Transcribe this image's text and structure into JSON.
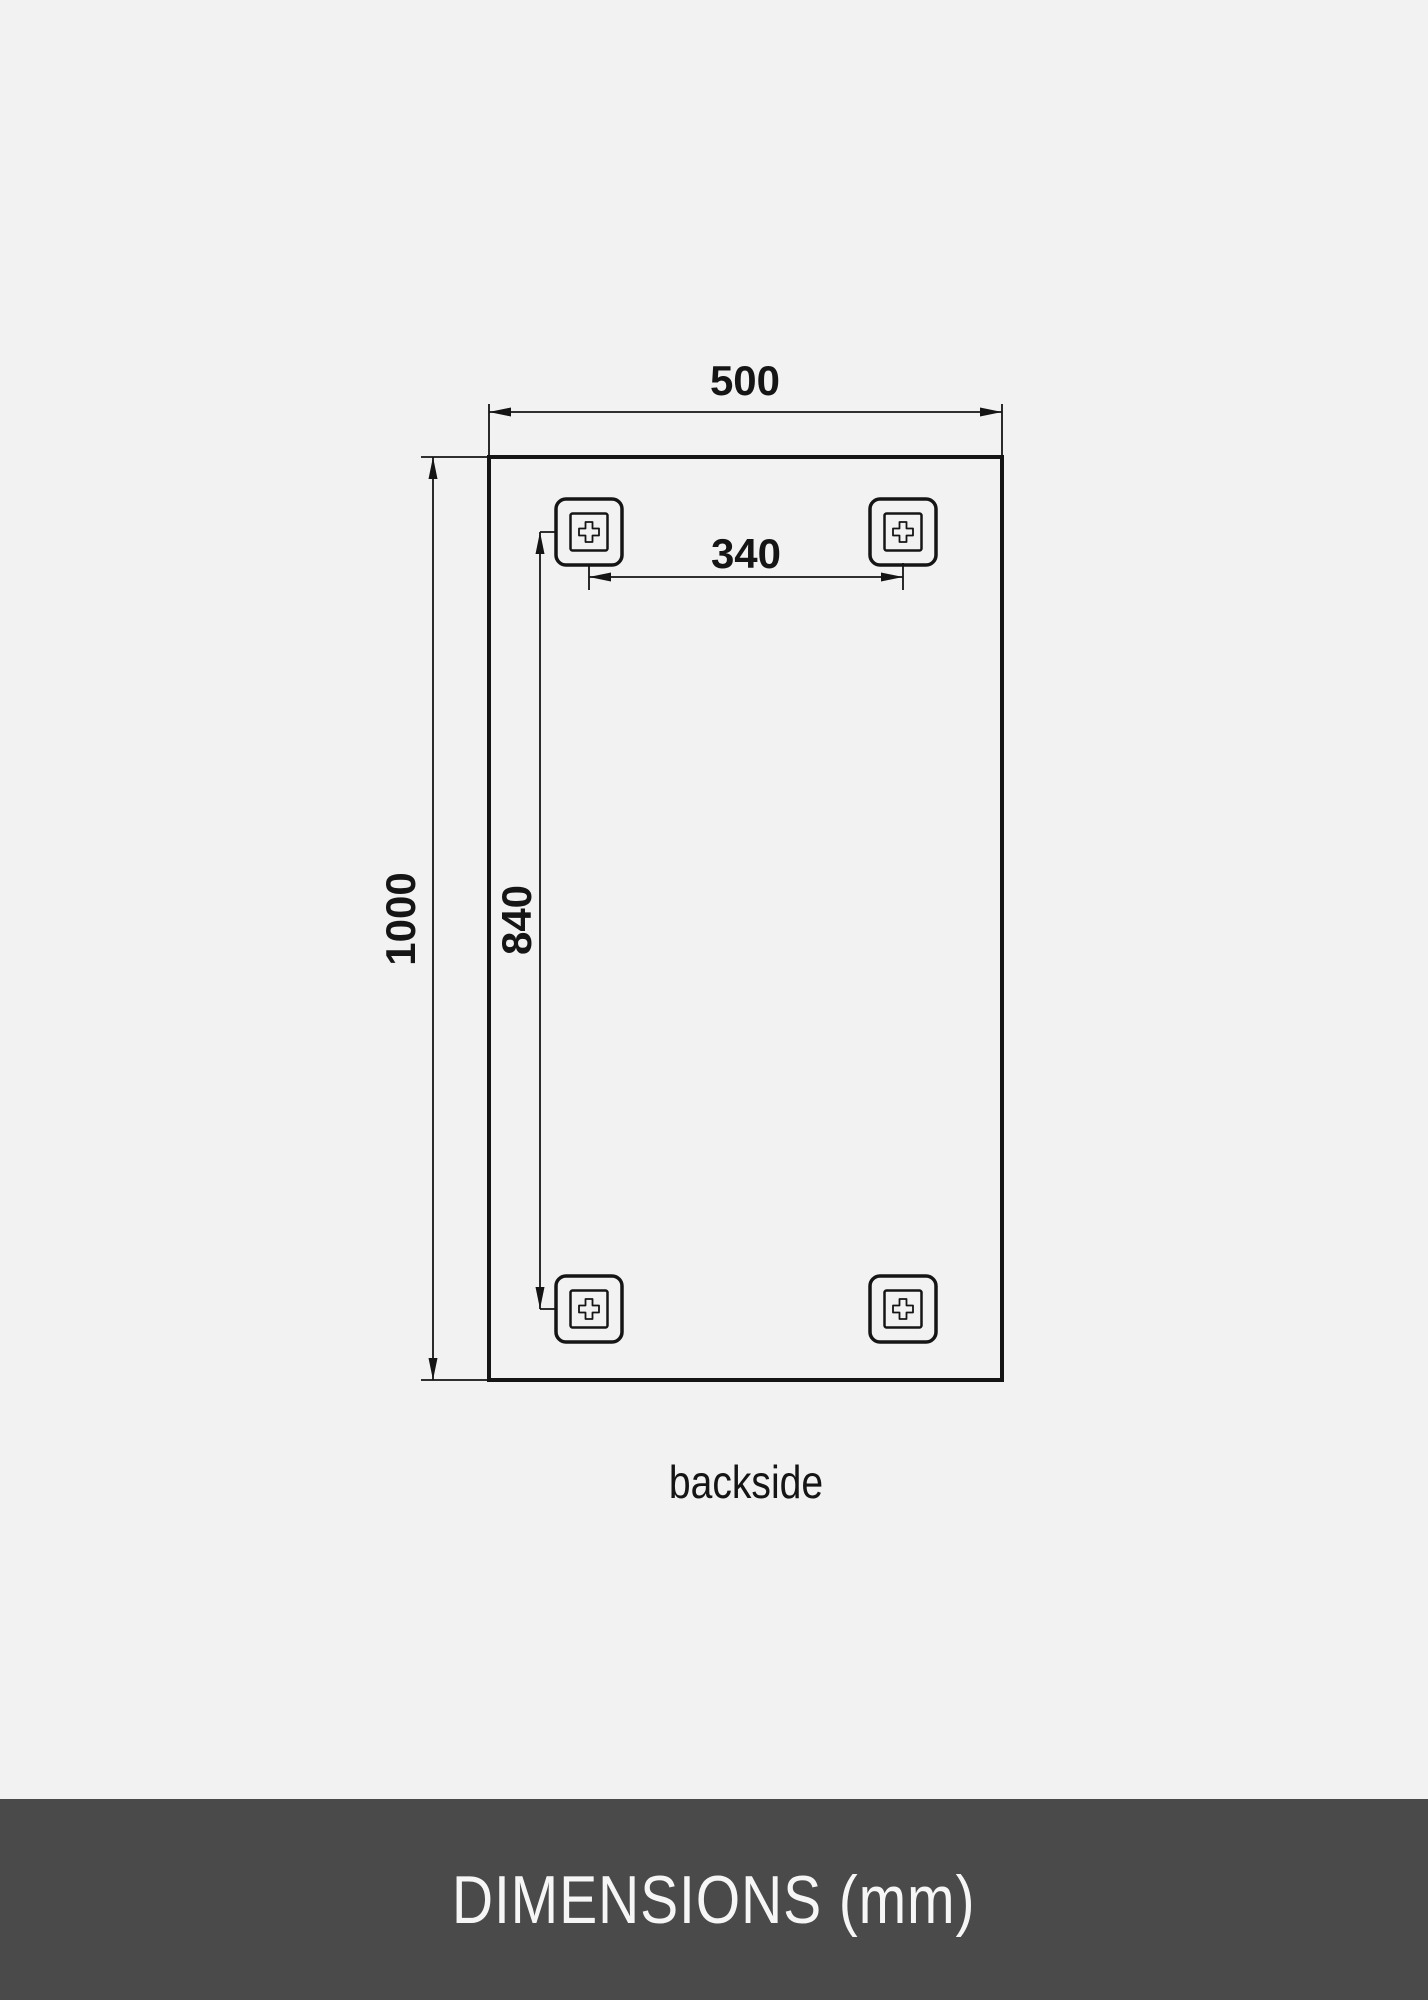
{
  "colors": {
    "background": "#f2f2f2",
    "line": "#151515",
    "footer_background": "#4a4a4a",
    "footer_text": "#f6f6f6"
  },
  "diagram": {
    "width_mm": "500",
    "height_mm": "1000",
    "hanger_span_vertical_mm": "840",
    "hanger_span_horizontal_mm": "340",
    "view_caption": "backside"
  },
  "footer": {
    "title": "DIMENSIONS (mm)"
  }
}
